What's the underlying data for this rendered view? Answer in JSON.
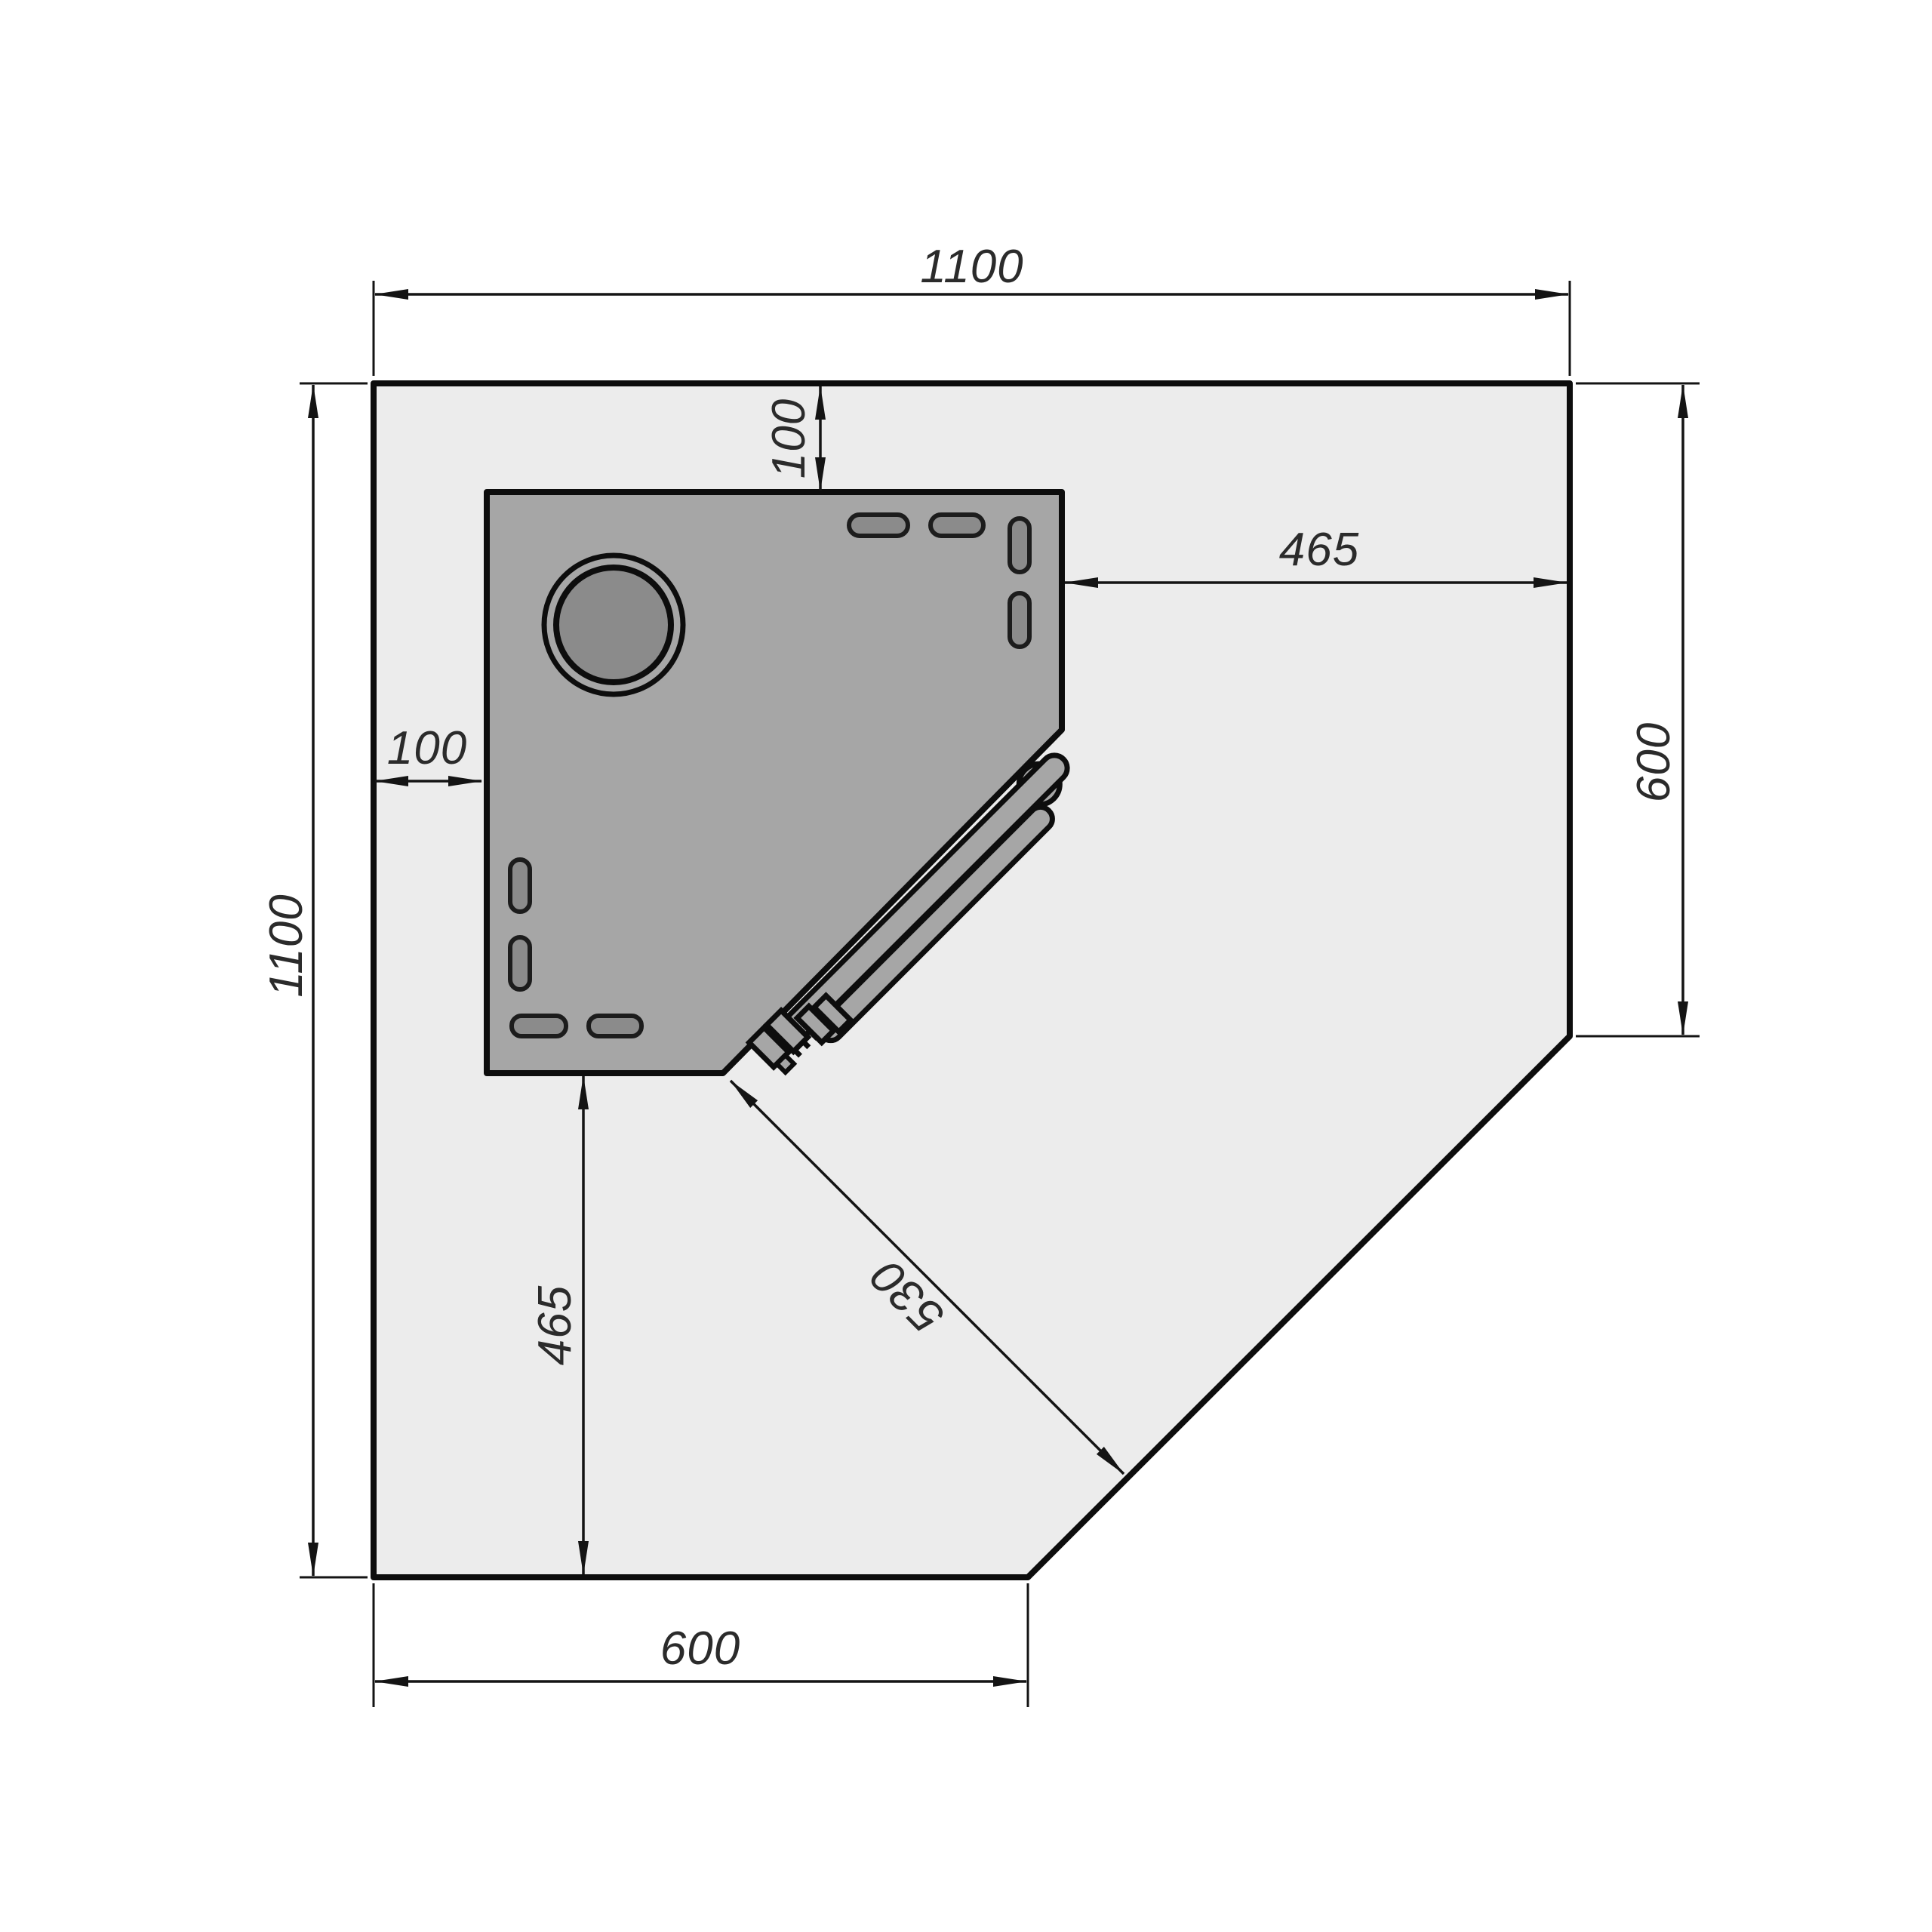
{
  "drawing": {
    "dimensions": {
      "top_width": {
        "value": "1100"
      },
      "left_height": {
        "value": "1100"
      },
      "top_offset": {
        "value": "100"
      },
      "left_offset": {
        "value": "100"
      },
      "right_clearance": {
        "value": "465"
      },
      "right_edge": {
        "value": "600"
      },
      "bottom_clearance": {
        "value": "465"
      },
      "diagonal_clearance": {
        "value": "530"
      },
      "bottom_edge": {
        "value": "600"
      }
    },
    "colors": {
      "background": "#ffffff",
      "floor": "#ececec",
      "appliance": "#a6a6a6",
      "appliance_detail": "#8b8b8b",
      "outline": "#0d0d0d"
    }
  }
}
